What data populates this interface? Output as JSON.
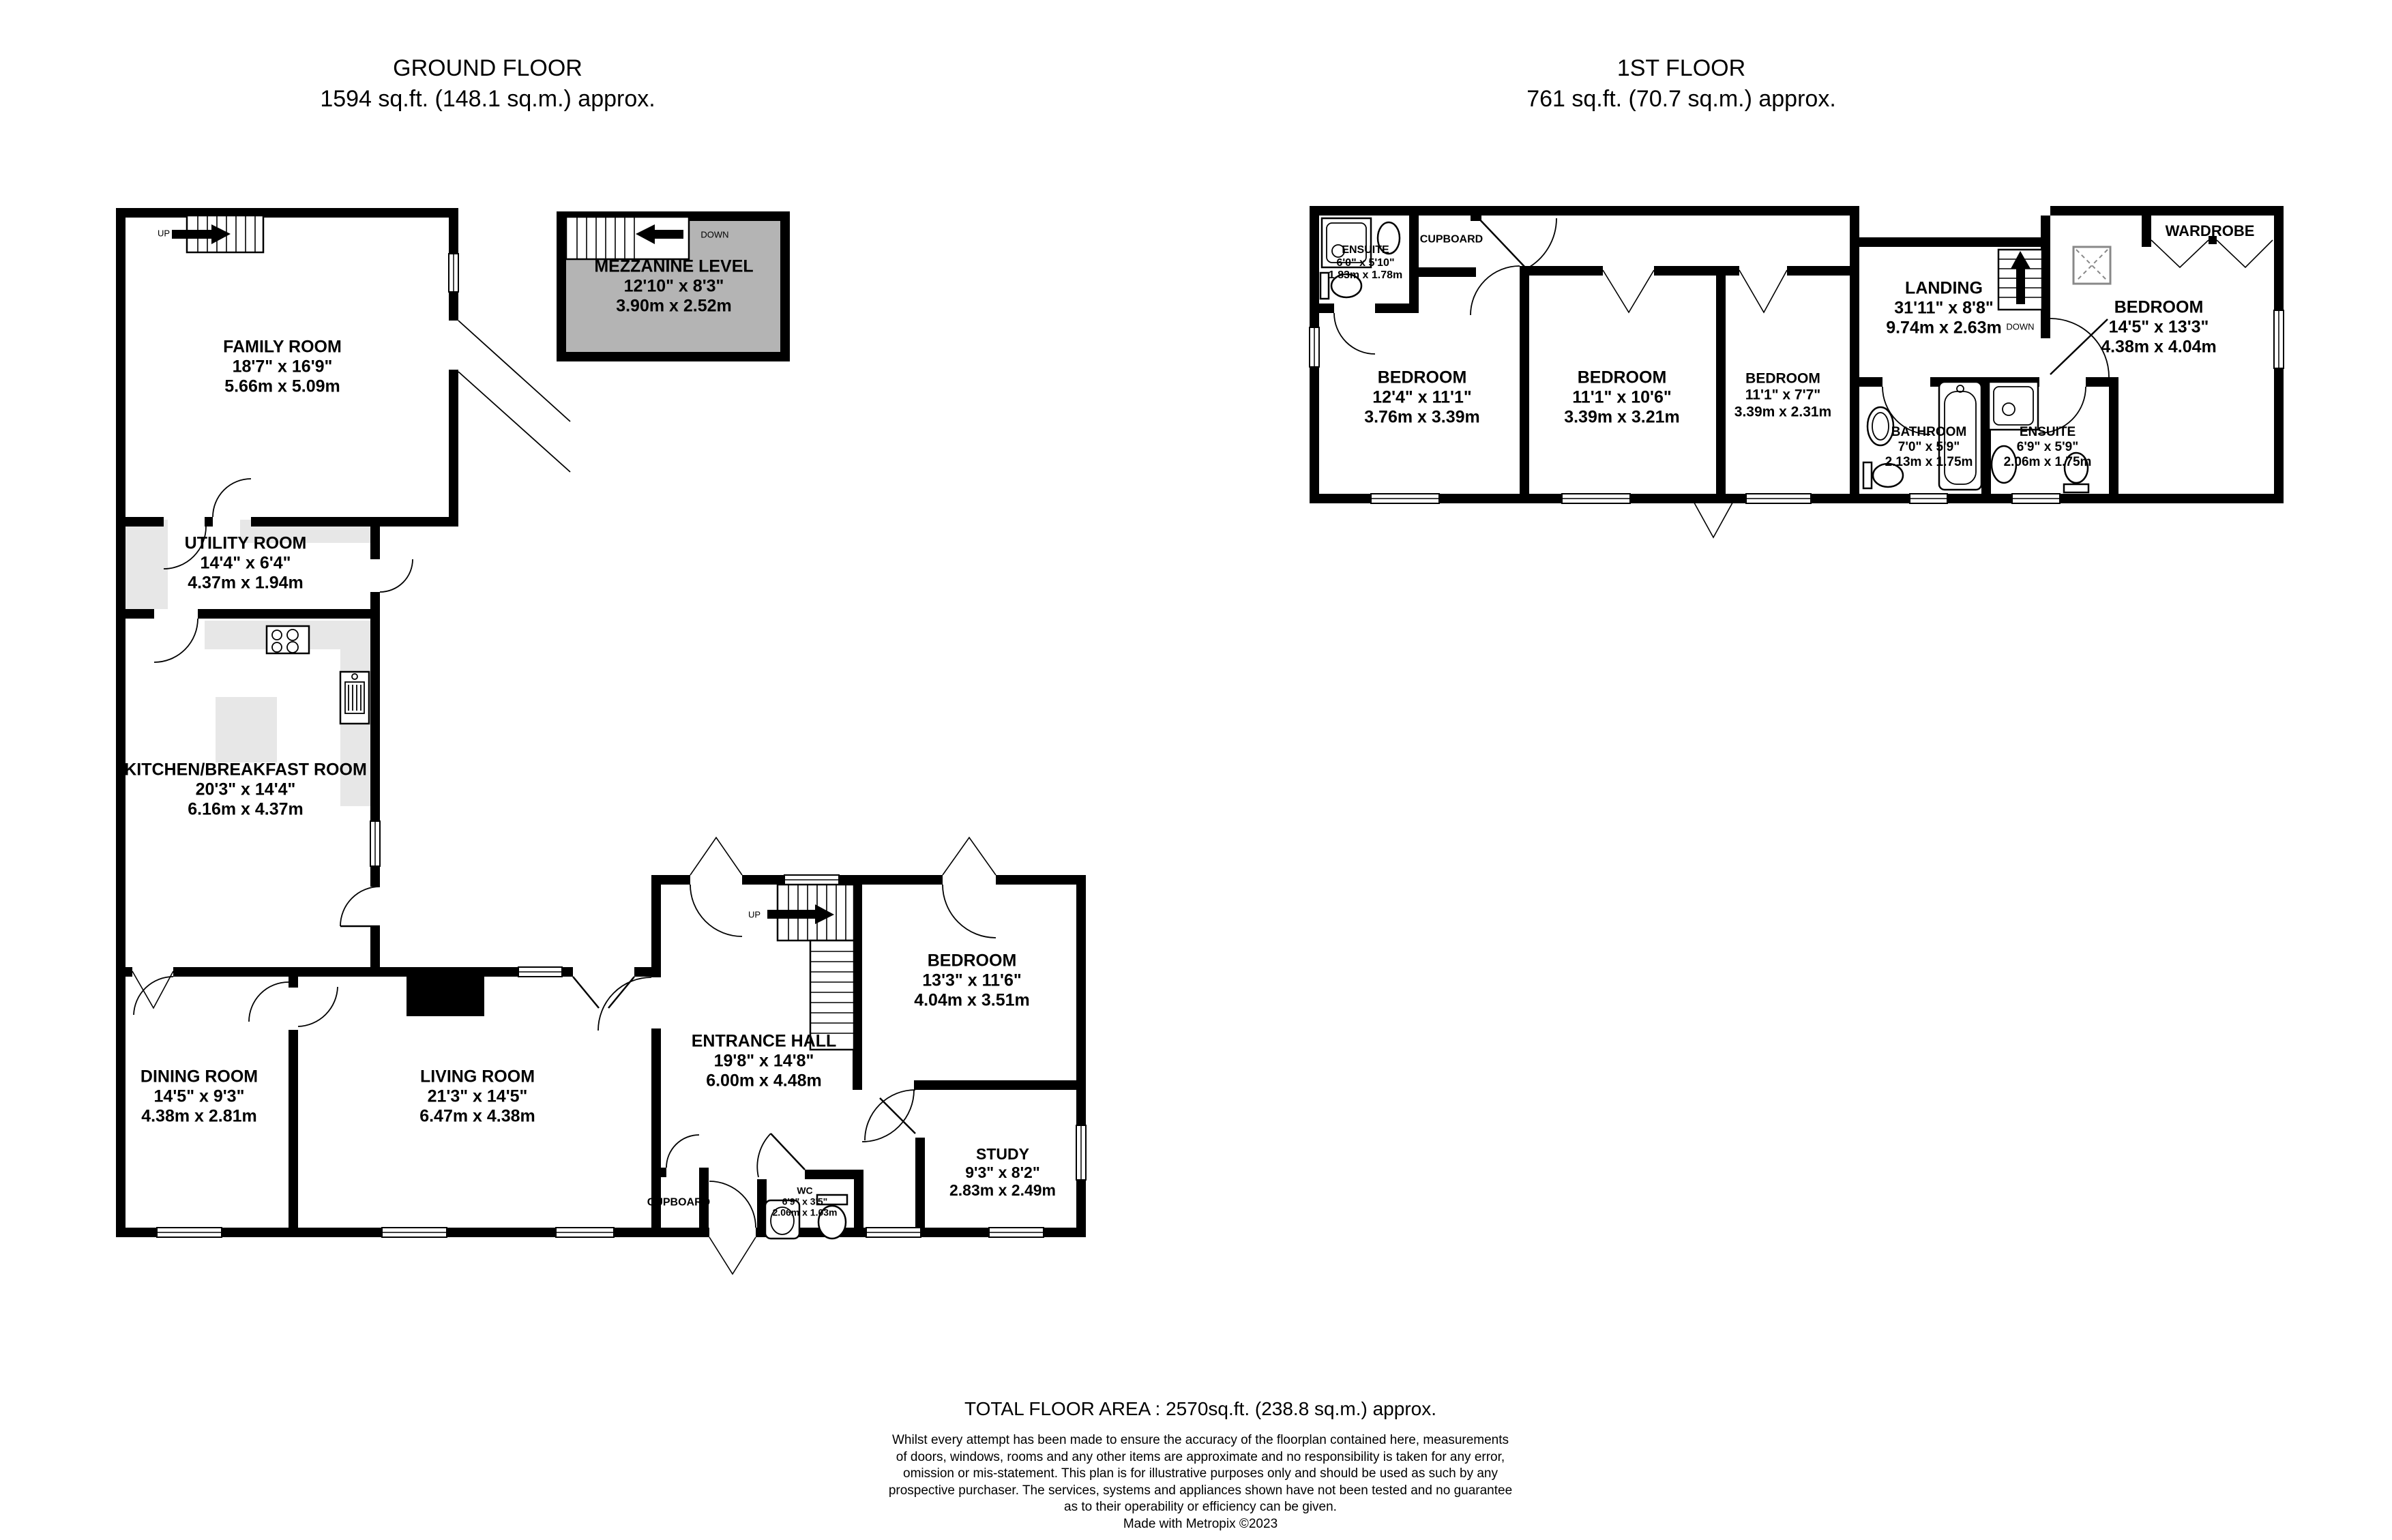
{
  "titles": {
    "ground": {
      "line1": "GROUND FLOOR",
      "line2": "1594 sq.ft. (148.1 sq.m.) approx."
    },
    "first": {
      "line1": "1ST FLOOR",
      "line2": "761 sq.ft. (70.7 sq.m.) approx."
    }
  },
  "ground": {
    "family": {
      "name": "FAMILY ROOM",
      "imp": "18'7\"  x 16'9\"",
      "met": "5.66m  x 5.09m"
    },
    "mezzanine": {
      "name": "MEZZANINE LEVEL",
      "imp": "12'10\"  x 8'3\"",
      "met": "3.90m  x 2.52m"
    },
    "utility": {
      "name": "UTILITY ROOM",
      "imp": "14'4\"  x 6'4\"",
      "met": "4.37m  x 1.94m"
    },
    "kitchen": {
      "name": "KITCHEN/BREAKFAST ROOM",
      "imp": "20'3\"  x 14'4\"",
      "met": "6.16m  x 4.37m"
    },
    "dining": {
      "name": "DINING ROOM",
      "imp": "14'5\"  x 9'3\"",
      "met": "4.38m  x 2.81m"
    },
    "living": {
      "name": "LIVING ROOM",
      "imp": "21'3\"  x 14'5\"",
      "met": "6.47m  x 4.38m"
    },
    "entrance": {
      "name": "ENTRANCE HALL",
      "imp": "19'8\"  x 14'8\"",
      "met": "6.00m  x 4.48m"
    },
    "bedroom": {
      "name": "BEDROOM",
      "imp": "13'3\"  x 11'6\"",
      "met": "4.04m  x 3.51m"
    },
    "study": {
      "name": "STUDY",
      "imp": "9'3\"  x 8'2\"",
      "met": "2.83m  x 2.49m"
    },
    "wc": {
      "name": "WC",
      "imp": "6'9\"  x 3'5\"",
      "met": "2.06m  x 1.03m"
    },
    "cupboard": {
      "name": "CUPBOARD"
    }
  },
  "first": {
    "ensuite1": {
      "name": "ENSUITE",
      "imp": "6'0\"  x 5'10\"",
      "met": "1.83m  x 1.78m"
    },
    "cupboard": {
      "name": "CUPBOARD"
    },
    "bed1": {
      "name": "BEDROOM",
      "imp": "12'4\"  x 11'1\"",
      "met": "3.76m  x 3.39m"
    },
    "bed2": {
      "name": "BEDROOM",
      "imp": "11'1\"  x 10'6\"",
      "met": "3.39m  x 3.21m"
    },
    "bed3": {
      "name": "BEDROOM",
      "imp": "11'1\"  x 7'7\"",
      "met": "3.39m  x 2.31m"
    },
    "landing": {
      "name": "LANDING",
      "imp": "31'11\"  x 8'8\"",
      "met": "9.74m  x 2.63m"
    },
    "bathroom": {
      "name": "BATHROOM",
      "imp": "7'0\"  x 5'9\"",
      "met": "2.13m  x 1.75m"
    },
    "ensuite2": {
      "name": "ENSUITE",
      "imp": "6'9\"  x 5'9\"",
      "met": "2.06m  x 1.75m"
    },
    "bed4": {
      "name": "BEDROOM",
      "imp": "14'5\"  x 13'3\"",
      "met": "4.38m  x 4.04m"
    },
    "wardrobe": {
      "name": "WARDROBE"
    }
  },
  "labels": {
    "up": "UP",
    "down": "DOWN"
  },
  "footer": {
    "total": "TOTAL FLOOR AREA : 2570sq.ft. (238.8 sq.m.) approx.",
    "line1": "Whilst every attempt has been made to ensure the accuracy of the floorplan contained here, measurements",
    "line2": "of doors, windows, rooms and any other items are approximate and no responsibility is taken for any error,",
    "line3": "omission or mis-statement. This plan is for illustrative purposes only and should be used as such by any",
    "line4": "prospective purchaser. The services, systems and appliances shown have not been tested and no guarantee",
    "line5": "as to their operability or efficiency can be given.",
    "credit": "Made with Metropix ©2023"
  },
  "colors": {
    "wall": "#000000",
    "counter": "#e7e7e7",
    "mezzanine_fill": "#b4b4b4"
  }
}
